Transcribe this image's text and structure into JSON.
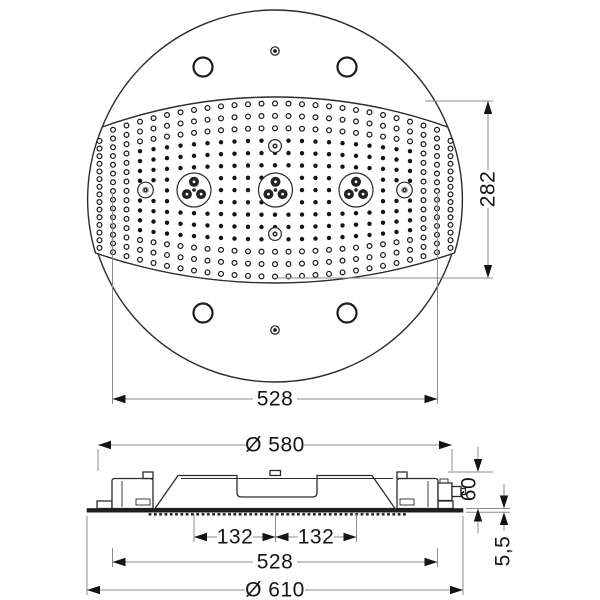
{
  "drawing": {
    "title": "shower-head-technical-drawing",
    "dimensions": {
      "face_width_top": "528",
      "face_height": "282",
      "housing_diameter": "Ø 580",
      "nozzle_spacing_left": "132",
      "nozzle_spacing_right": "132",
      "face_width_side": "528",
      "plate_diameter": "Ø 610",
      "housing_height": "60",
      "plate_thickness": "5,5"
    },
    "colors": {
      "background": "#ffffff",
      "outline": "#2b2b2b",
      "ink": "#141414",
      "dim_line": "#8c8c8c"
    }
  }
}
